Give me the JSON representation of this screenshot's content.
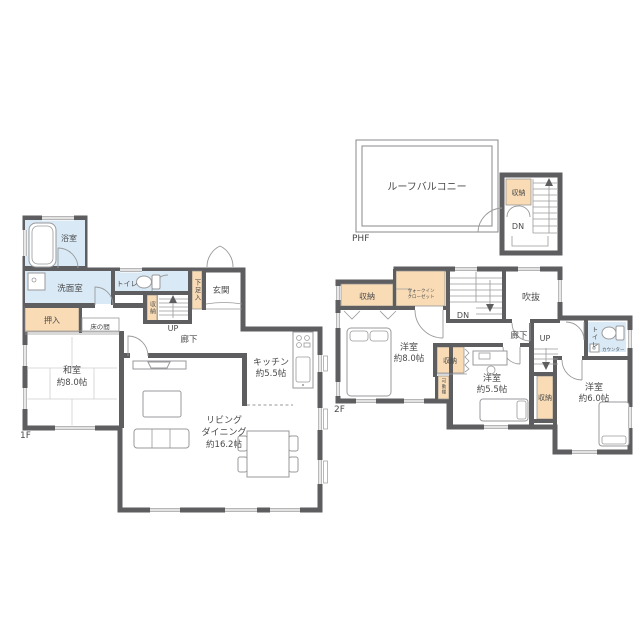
{
  "title": "2階建て住宅 間取り図",
  "colors": {
    "wall": "#5E5E60",
    "wet_area": "#D9EAF6",
    "storage_fill": "#F9DCB5",
    "outline": "#8A8A8C",
    "text": "#4A4A4C",
    "background": "#FFFFFF"
  },
  "phf": {
    "floor_label": "PHF",
    "roof_balcony": "ルーフバルコニー",
    "storage": "収納",
    "stairs_down": "DN"
  },
  "f1": {
    "floor_label": "1F",
    "bath": "浴室",
    "washroom": "洗面室",
    "toilet": "トイレ",
    "closet_oshiire": "押入",
    "tokonoma": "床の間",
    "stair_storage": "収納",
    "stairs_up": "UP",
    "shoe_cabinet": "下足入",
    "entrance": "玄関",
    "hallway": "廊下",
    "washitsu": {
      "name": "和室",
      "size": "約8.0帖"
    },
    "kitchen": {
      "name": "キッチン",
      "size": "約5.5帖"
    },
    "living": {
      "name_line1": "リビング",
      "name_line2": "ダイニング",
      "size": "約16.2帖"
    }
  },
  "f2": {
    "floor_label": "2F",
    "storage_nw": "収納",
    "walk_in_closet": {
      "line1": "ウォークイン",
      "line2": "クローゼット"
    },
    "room_8": {
      "name": "洋室",
      "size": "約8.0帖"
    },
    "stairs_down": "DN",
    "void": "吹抜",
    "hallway": "廊下",
    "stairs_up": "UP",
    "toilet": "トイレ",
    "counter": "カウンター",
    "storage_mid": "収納",
    "movable_shelf": "可動棚",
    "room_55": {
      "name": "洋室",
      "size": "約5.5帖"
    },
    "storage_e": "収納",
    "room_6": {
      "name": "洋室",
      "size": "約6.0帖"
    }
  }
}
